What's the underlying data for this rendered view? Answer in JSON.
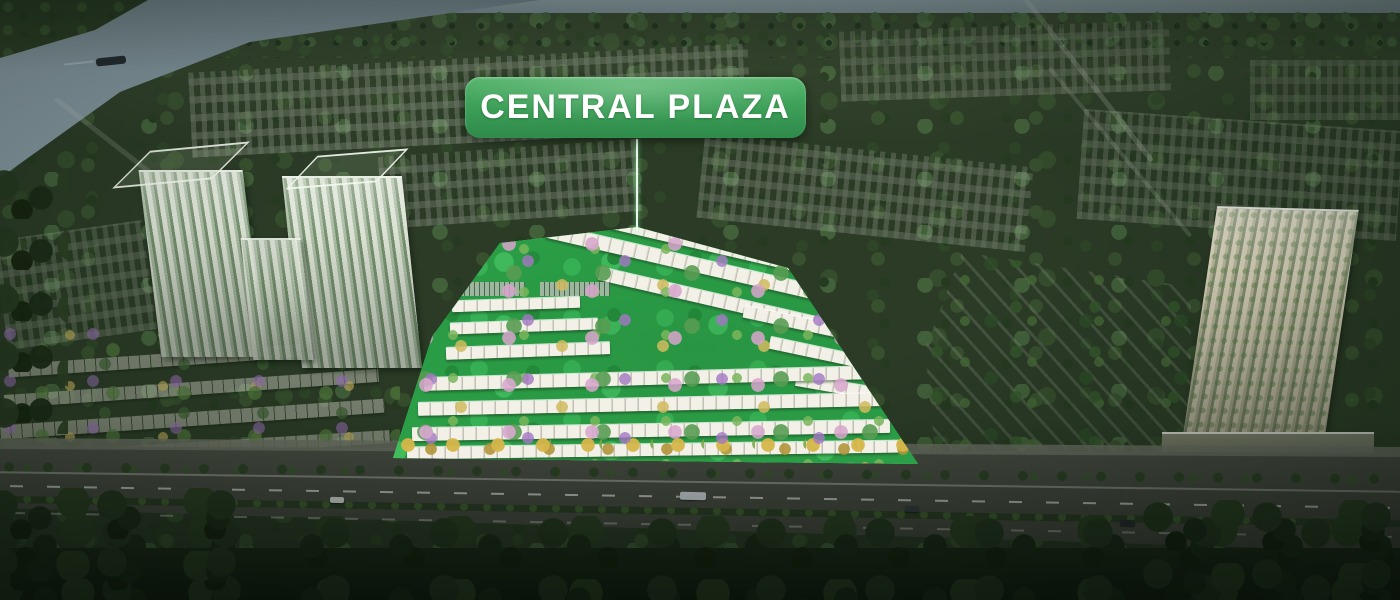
{
  "callout": {
    "label": "CENTRAL PLAZA"
  },
  "colors": {
    "callout_green": "#3fa45c",
    "callout_text": "#ffffff",
    "highlight_glow": "#2ee06a",
    "estate_grass": "#2fae4e",
    "river_water": "#7b8d96",
    "boulevard_asphalt": "#53584f",
    "foreground_forest": "#1c2a17"
  },
  "scene": {
    "type": "aerial-masterplan-render",
    "highlighted_area": "central-plaza-lowrise-parcel",
    "landmarks": {
      "river_position": "top-left",
      "boats_on_river": 1,
      "left_highrise_towers": 2,
      "right_highrise_towers": 1,
      "boulevard_position": "bottom",
      "foreground_treeline": "bottom-edge"
    }
  }
}
